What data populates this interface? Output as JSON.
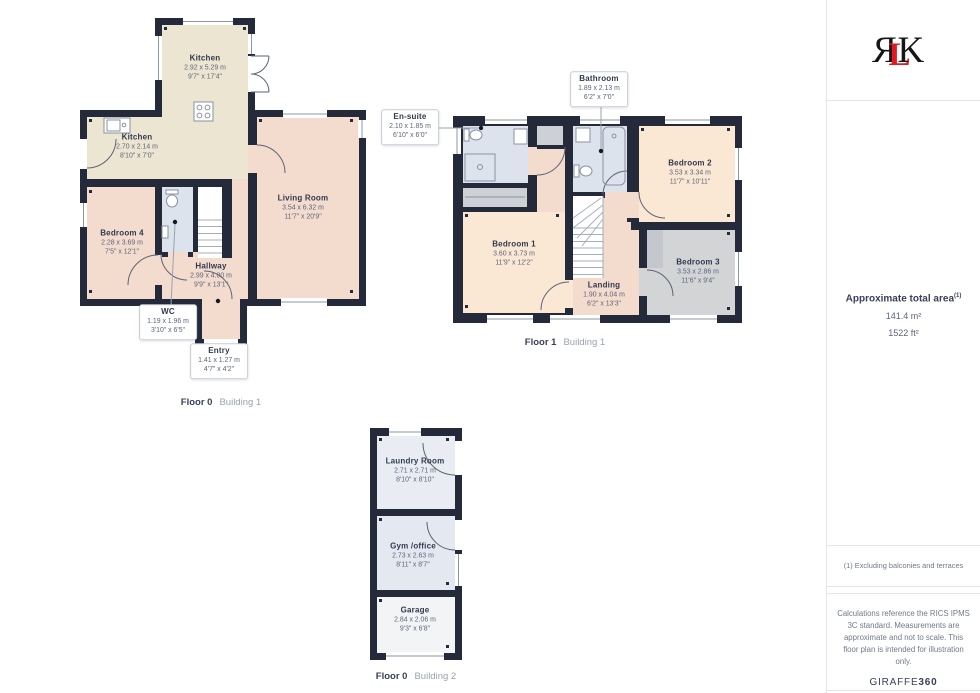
{
  "plans": [
    {
      "floor_label": "Floor 0",
      "building_label": "Building 1",
      "rooms": [
        {
          "name": "Kitchen",
          "dims_m": "2.92 x 5.29 m",
          "dims_ft": "9'7\" x 17'4\""
        },
        {
          "name": "Kitchen",
          "dims_m": "2.70 x 2.14 m",
          "dims_ft": "8'10\" x 7'0\""
        },
        {
          "name": "Living Room",
          "dims_m": "3.54 x 6.32 m",
          "dims_ft": "11'7\" x 20'9\""
        },
        {
          "name": "Bedroom 4",
          "dims_m": "2.28 x 3.69 m",
          "dims_ft": "7'5\" x 12'1\""
        },
        {
          "name": "Hallway",
          "dims_m": "2.99 x 4.00 m",
          "dims_ft": "9'9\" x 13'1\""
        },
        {
          "name": "WC",
          "dims_m": "1.19 x 1.96 m",
          "dims_ft": "3'10\" x 6'5\""
        },
        {
          "name": "Entry",
          "dims_m": "1.41 x 1.27 m",
          "dims_ft": "4'7\" x 4'2\""
        }
      ]
    },
    {
      "floor_label": "Floor 1",
      "building_label": "Building 1",
      "rooms": [
        {
          "name": "Bathroom",
          "dims_m": "1.89 x 2.13 m",
          "dims_ft": "6'2\" x 7'0\""
        },
        {
          "name": "En-suite",
          "dims_m": "2.10 x 1.85 m",
          "dims_ft": "6'10\" x 6'0\""
        },
        {
          "name": "Bedroom 2",
          "dims_m": "3.53 x 3.34 m",
          "dims_ft": "11'7\" x 10'11\""
        },
        {
          "name": "Bedroom 1",
          "dims_m": "3.60 x 3.73 m",
          "dims_ft": "11'9\" x 12'2\""
        },
        {
          "name": "Landing",
          "dims_m": "1.90 x 4.04 m",
          "dims_ft": "6'2\" x 13'3\""
        },
        {
          "name": "Bedroom 3",
          "dims_m": "3.53 x 2.86 m",
          "dims_ft": "11'6\" x 9'4\""
        }
      ]
    },
    {
      "floor_label": "Floor 0",
      "building_label": "Building 2",
      "rooms": [
        {
          "name": "Laundry Room",
          "dims_m": "2.71 x 2.71 m",
          "dims_ft": "8'10\" x 8'10\""
        },
        {
          "name": "Gym /office",
          "dims_m": "2.73 x 2.63 m",
          "dims_ft": "8'11\" x 8'7\""
        },
        {
          "name": "Garage",
          "dims_m": "2.84 x 2.06 m",
          "dims_ft": "9'3\" x 6'8\""
        }
      ]
    }
  ],
  "sidebar": {
    "logo": {
      "letter_r": "R",
      "letter_l": "L",
      "letter_k": "K"
    },
    "area": {
      "title": "Approximate total area",
      "footnote_marker": "(1)",
      "value_metric": "141.4 m²",
      "value_imperial": "1522 ft²"
    },
    "footnote": "(1) Excluding balconies and terraces",
    "disclaimer": "Calculations reference the RICS IPMS 3C standard. Measurements are approximate and not to scale. This floor plan is intended for illustration only.",
    "brand": {
      "name": "GIRAFFE",
      "suffix": "360"
    }
  },
  "colors": {
    "wall": "#242a39",
    "kitchen_fill": "#ece5d1",
    "living_fill": "#f3dbce",
    "bedroom_fill": "#fbe8d4",
    "bathroom_fill": "#dde3ed",
    "gray_room_fill": "#d3d4d6",
    "accent_red": "#e11b22"
  }
}
